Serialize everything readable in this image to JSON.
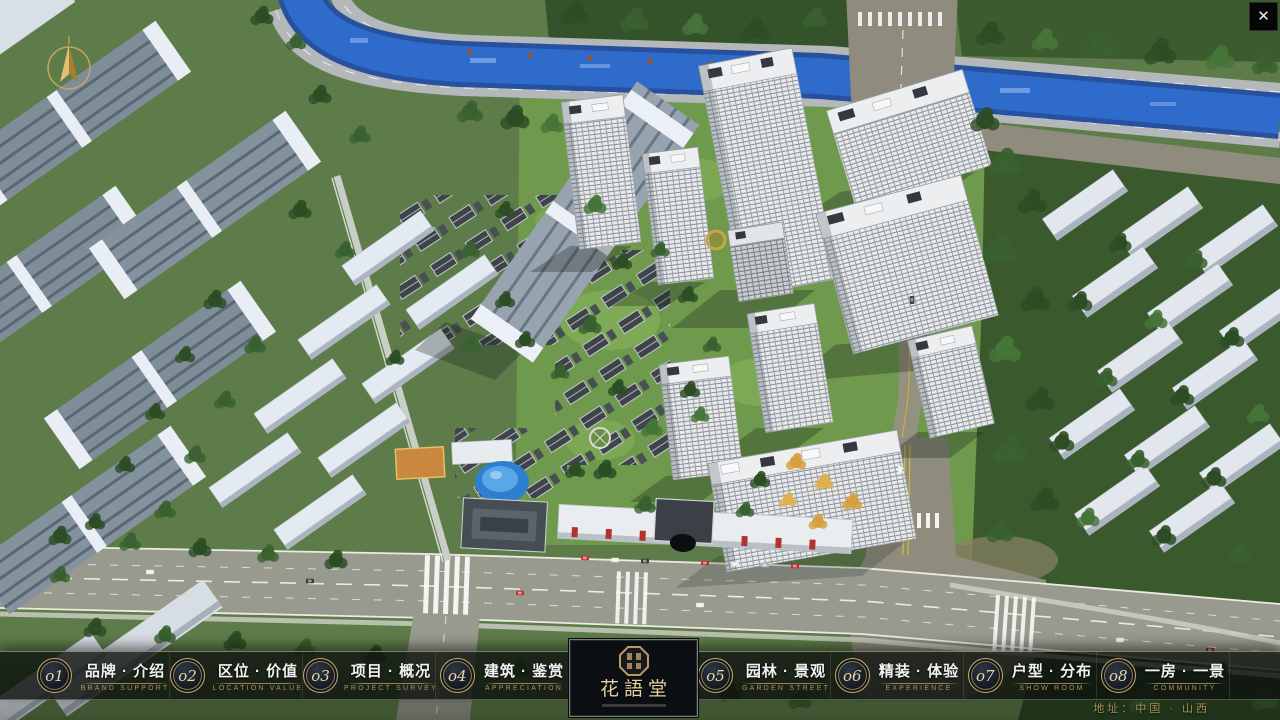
{
  "window": {
    "close_icon": "✕"
  },
  "logo": {
    "title": "花語堂"
  },
  "nav": {
    "items": [
      {
        "num": "o1",
        "zh": "品牌 · 介绍",
        "en": "BRAND SUPPORT"
      },
      {
        "num": "o2",
        "zh": "区位 · 价值",
        "en": "LOCATION VALUE"
      },
      {
        "num": "o3",
        "zh": "项目 · 概况",
        "en": "PROJECT SURVEY"
      },
      {
        "num": "o4",
        "zh": "建筑 · 鉴赏",
        "en": "APPRECIATION"
      },
      {
        "num": "o5",
        "zh": "园林 · 景观",
        "en": "GARDEN STREET"
      },
      {
        "num": "o6",
        "zh": "精装 · 体验",
        "en": "EXPERIENCE"
      },
      {
        "num": "o7",
        "zh": "户型 · 分布",
        "en": "SHOW ROOM"
      },
      {
        "num": "o8",
        "zh": "一房 · 一景",
        "en": "COMMUNITY"
      }
    ]
  },
  "map_overlay": {
    "address_label": "地址：中国 · 山西"
  },
  "icons": {
    "compass": "compass-north-arrow",
    "seal": "brand-seal-stamp"
  },
  "colors": {
    "gold": "#c5a86b",
    "bar_background": "#0d110e",
    "river_blue": "#2a63c4",
    "grass_green": "#5e7c49",
    "tower_white": "#e8eaec",
    "accent_red": "#b23230"
  }
}
